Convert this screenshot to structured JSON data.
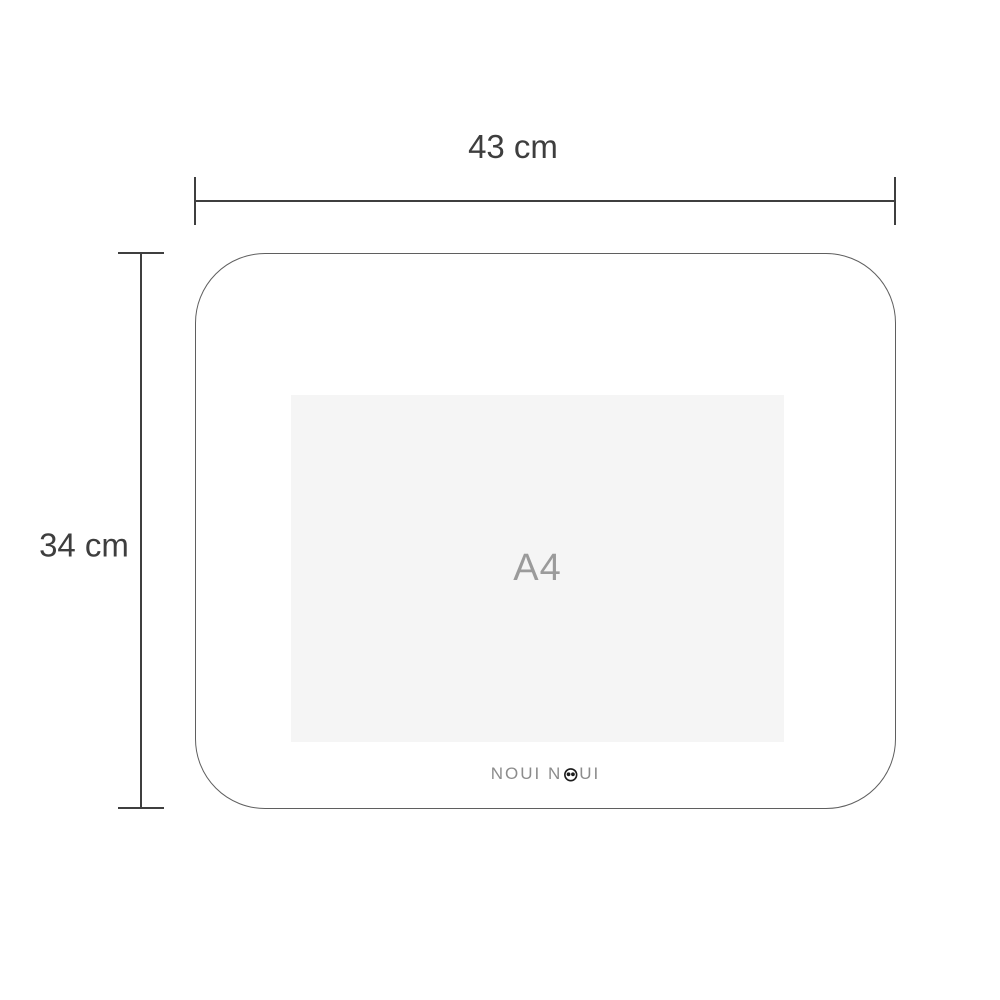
{
  "diagram": {
    "width_dimension": {
      "label": "43 cm"
    },
    "height_dimension": {
      "label": "34 cm"
    },
    "placemat": {
      "insert_label": "A4",
      "brand": {
        "full_name": "NOUI NOUI",
        "text_before_face": "NOUI N",
        "text_after_face": "UI"
      }
    },
    "colors": {
      "background": "#ffffff",
      "dimension_line": "#3f3f3f",
      "dimension_text": "#3e3e3e",
      "mat_border": "#5f5f5f",
      "insert_background": "#f5f5f5",
      "insert_text": "#9b9b9b",
      "brand_text": "#8c8c8c",
      "face_icon": "#1c1c1c"
    }
  }
}
